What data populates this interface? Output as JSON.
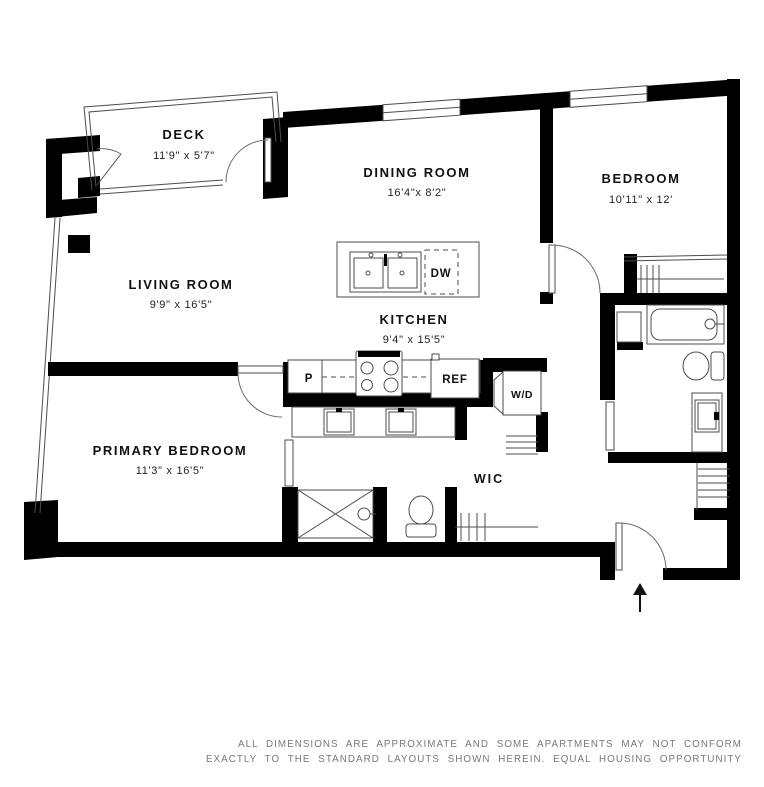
{
  "floorplan": {
    "rooms": [
      {
        "id": "deck",
        "name": "DECK",
        "dims": "11'9\" x 5'7\""
      },
      {
        "id": "dining-room",
        "name": "DINING ROOM",
        "dims": "16'4\"x 8'2\""
      },
      {
        "id": "bedroom",
        "name": "BEDROOM",
        "dims": "10'11\" x 12'"
      },
      {
        "id": "living-room",
        "name": "LIVING ROOM",
        "dims": "9'9\" x 16'5\""
      },
      {
        "id": "kitchen",
        "name": "KITCHEN",
        "dims": "9'4\" x 15'5\""
      },
      {
        "id": "primary-bedroom",
        "name": "PRIMARY BEDROOM",
        "dims": "11'3\" x 16'5\""
      }
    ],
    "fixtures": {
      "wic": "WIC",
      "dishwasher": "DW",
      "refrigerator": "REF",
      "pantry": "P",
      "washer_dryer": "W/D"
    },
    "disclaimer": {
      "line1": "ALL DIMENSIONS ARE APPROXIMATE AND SOME APARTMENTS MAY NOT CONFORM",
      "line2": "EXACTLY TO THE STANDARD LAYOUTS SHOWN HEREIN. EQUAL HOUSING OPPORTUNITY"
    },
    "colors": {
      "wall": "#000000",
      "thin_line": "#4d4d4d",
      "label": "#111111",
      "disclaimer": "#75787e",
      "background": "#ffffff"
    }
  }
}
